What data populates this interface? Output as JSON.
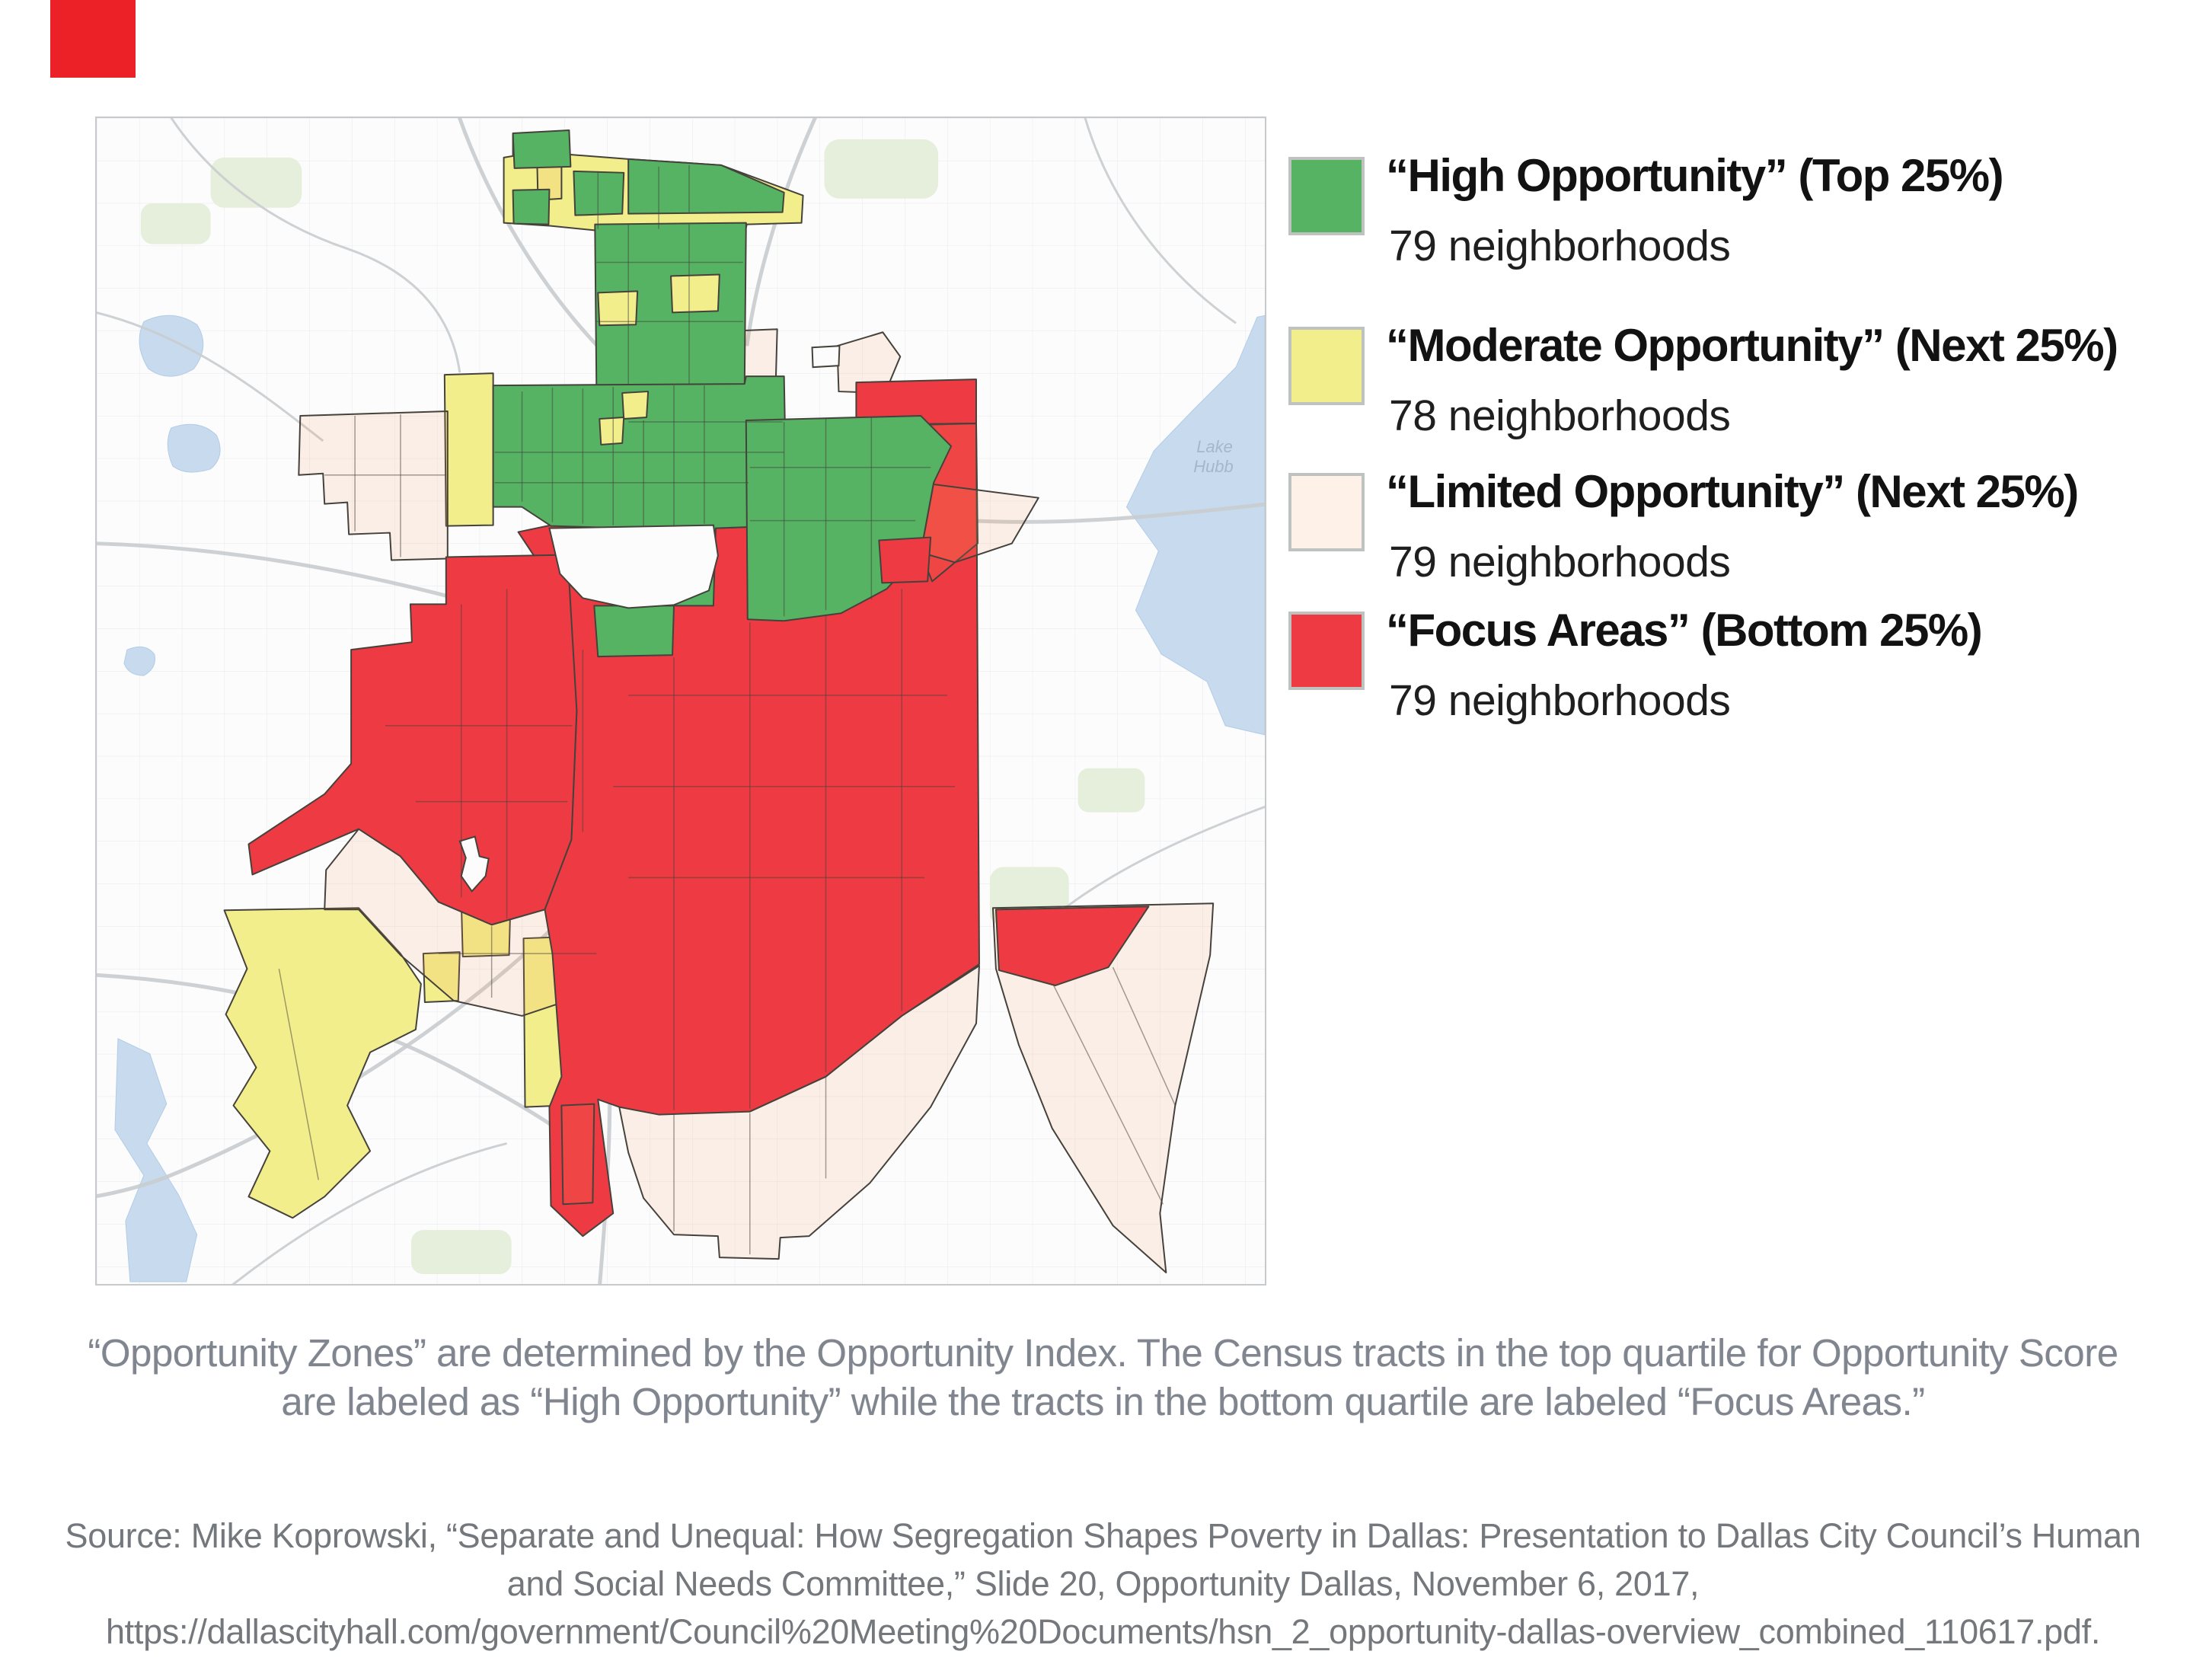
{
  "corner_mark": {
    "color": "#ec2127"
  },
  "legend": {
    "items": [
      {
        "key": "high",
        "title": "“High Opportunity” (Top 25%)",
        "count": "79 neighborhoods",
        "count_value": 79,
        "color": "#55b363"
      },
      {
        "key": "moderate",
        "title": "“Moderate Opportunity” (Next 25%)",
        "count": "78 neighborhoods",
        "count_value": 78,
        "color": "#f3ee8c"
      },
      {
        "key": "limited",
        "title": "“Limited Opportunity” (Next 25%)",
        "count": "79 neighborhoods",
        "count_value": 79,
        "color": "#f4985322"
      },
      {
        "key": "focus",
        "title": "“Focus Areas” (Bottom 25%)",
        "count": "79 neighborhoods",
        "count_value": 79,
        "color": "#ee3a43"
      }
    ]
  },
  "map": {
    "water_label": {
      "line1": "Lake",
      "line2": "Hubb"
    }
  },
  "caption": {
    "line1": "“Opportunity Zones” are determined by the Opportunity Index. The Census tracts in the top quartile for Opportunity Score",
    "line2": "are labeled as “High Opportunity” while the tracts in the bottom quartile are labeled “Focus Areas.”"
  },
  "source": {
    "line1": "Source:  Mike Koprowski, “Separate and Unequal: How Segregation Shapes Poverty in Dallas: Presentation to Dallas City Council’s Human",
    "line2": "and Social Needs Committee,” Slide 20, Opportunity Dallas, November 6, 2017,",
    "line3": "https://dallascityhall.com/government/Council%20Meeting%20Documents/hsn_2_opportunity-dallas-overview_combined_110617.pdf."
  }
}
